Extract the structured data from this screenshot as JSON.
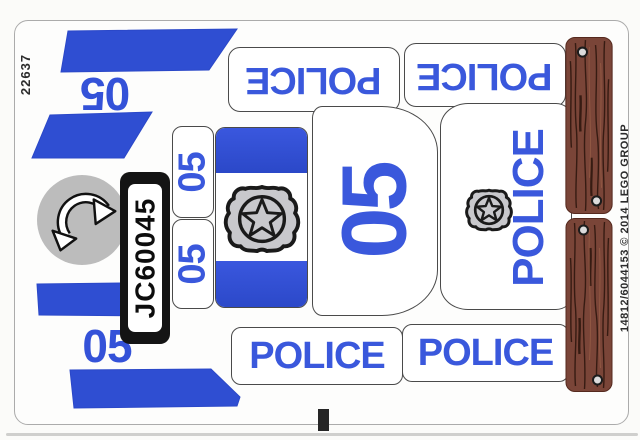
{
  "sheet": {
    "set_code": "22637",
    "part_code": "14812/6044153 © 2014 LEGO GROUP"
  },
  "labels": {
    "police": "POLICE",
    "number": "05",
    "license_plate": "JC60045"
  },
  "icons": {
    "badge": "police-star-badge",
    "arrow": "rotation-arrow",
    "nail": "nail-dot"
  },
  "colors": {
    "blue_fill": "#2f4ed2",
    "blue_text": "#3a58dc",
    "wood_brown": "#7a4538",
    "wood_grain": "#2b140c",
    "circle_gray": "#bcbcbc",
    "badge_gray": "#c8c8cc",
    "plate_black": "#141414"
  }
}
